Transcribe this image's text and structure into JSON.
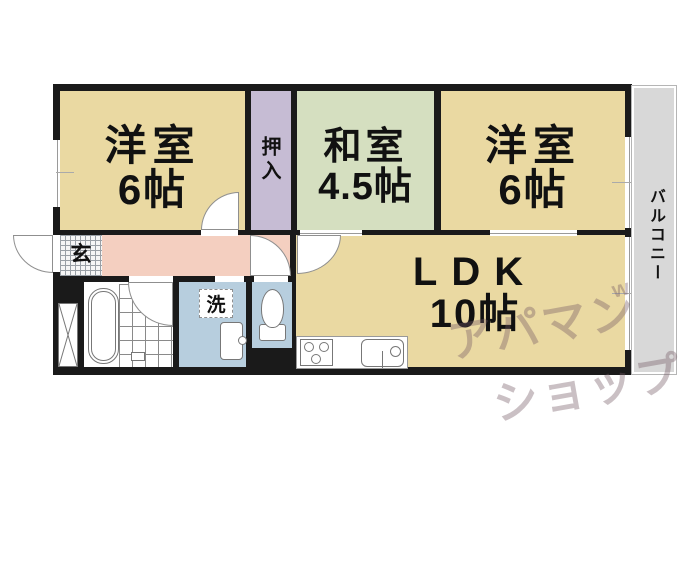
{
  "plan": {
    "rooms": {
      "western1": {
        "name": "洋室",
        "size": "6帖"
      },
      "closet": {
        "name": "押入"
      },
      "japanese": {
        "name": "和室",
        "size": "4.5帖"
      },
      "western2": {
        "name": "洋室",
        "size": "6帖"
      },
      "ldk": {
        "name": "LDK",
        "size": "10帖"
      },
      "balcony": {
        "name": "バルコニー"
      },
      "entrance": {
        "name": "玄"
      },
      "laundry": {
        "name": "洗"
      }
    },
    "watermark": {
      "line1": "アパマン",
      "line2": "ショップ",
      "mark": "w"
    },
    "colors": {
      "wall": "#1a1a1a",
      "western_room": "#ead9a2",
      "japanese_room": "#d5dfc0",
      "closet": "#c6bcd4",
      "corridor": "#f4cfc0",
      "wet_room": "#b7cede",
      "balcony": "#d8d8d8",
      "watermark": "rgba(115,90,100,0.38)"
    }
  }
}
